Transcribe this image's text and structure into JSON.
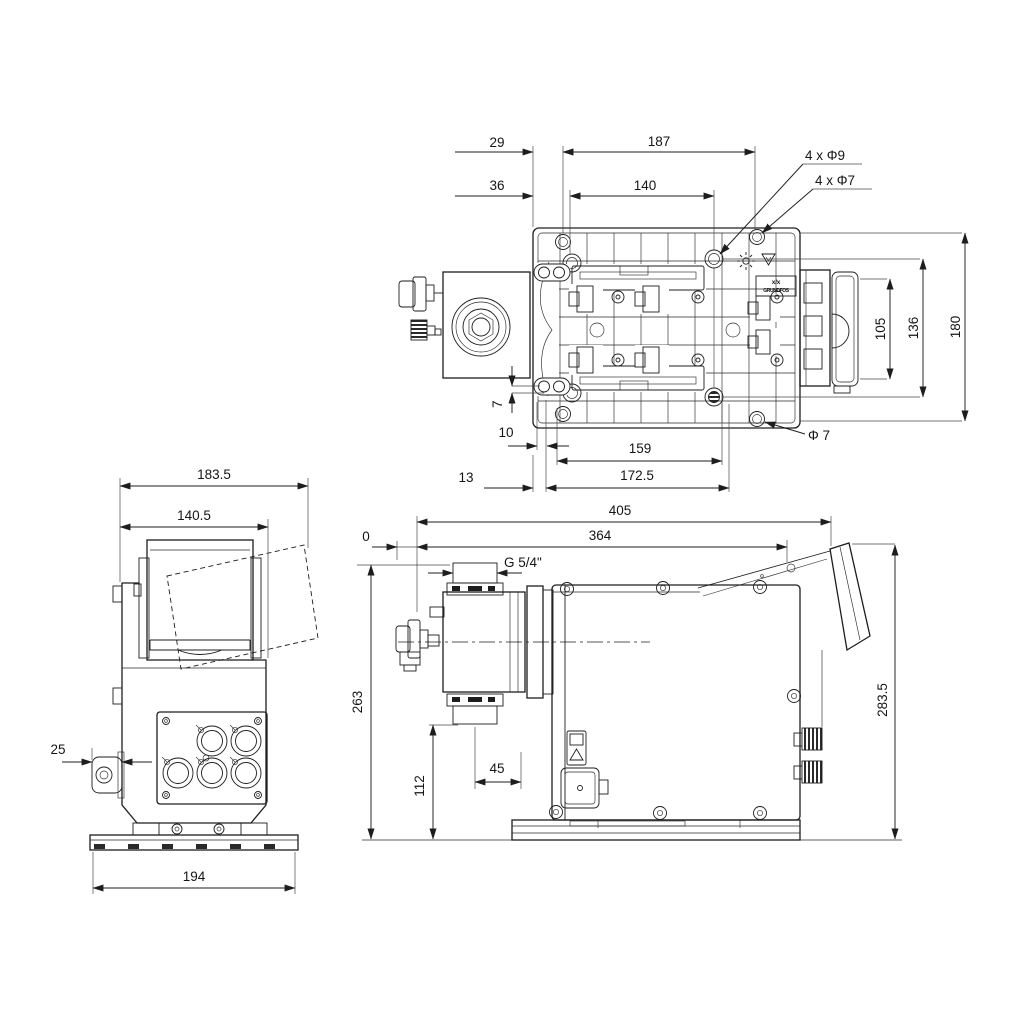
{
  "colors": {
    "line": "#1d1d1d",
    "dimension": "#151515",
    "extension": "#4a4a4a",
    "background": "#ffffff"
  },
  "views": {
    "top": {
      "dims": {
        "d29": "29",
        "d187": "187",
        "d36": "36",
        "d140": "140",
        "phi9": "4 x Φ9",
        "phi7": "4 x Φ7",
        "d105": "105",
        "d136": "136",
        "d180": "180",
        "d7": "7",
        "d10": "10",
        "d159": "159",
        "phi7b": "Φ 7",
        "d13": "13",
        "d1725": "172.5"
      },
      "label": {
        "line1": "x/x",
        "line2": "GRUNDFOS"
      }
    },
    "side": {
      "dims": {
        "d1835": "183.5",
        "d1405": "140.5",
        "d25": "25",
        "d194": "194"
      }
    },
    "front": {
      "dims": {
        "d405": "405",
        "d364": "364",
        "d0": "0",
        "thread": "G 5/4\"",
        "d263": "263",
        "d112": "112",
        "d45": "45",
        "d2835": "283.5"
      }
    }
  },
  "icons": {
    "plate_icon_1": "gear",
    "plate_icon_2": "recycle-triangle",
    "front_label": "warning-label",
    "side_panel": "circular-connectors"
  }
}
